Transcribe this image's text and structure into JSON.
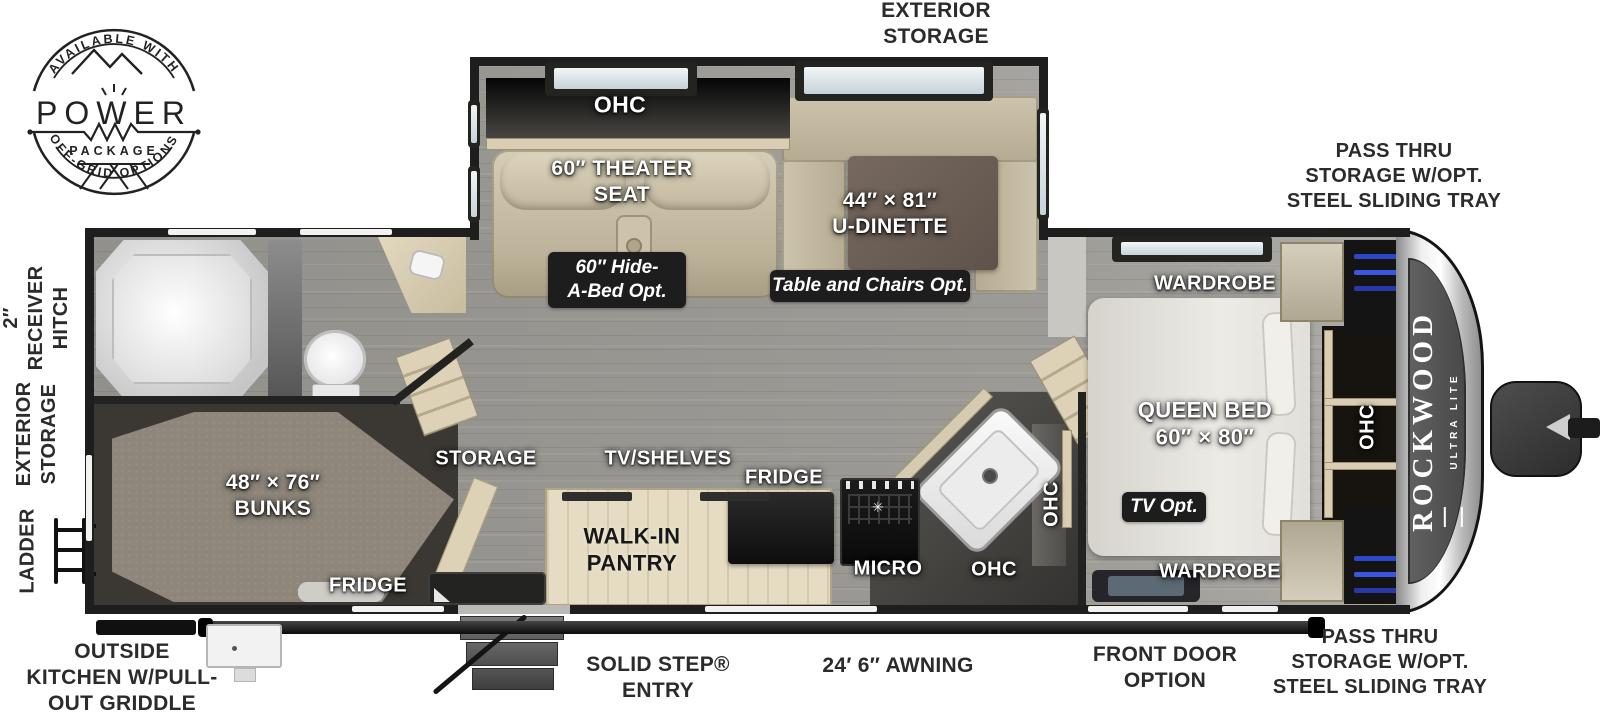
{
  "logo": {
    "arc_top": "AVAILABLE WITH",
    "word": "POWER",
    "package": "PACKAGE",
    "arc_bottom": "OFF-GRID OPTIONS"
  },
  "branding": {
    "name": "ROCKWOOD",
    "trim": "ULTRA LITE"
  },
  "exterior": {
    "top_storage": [
      "EXTERIOR",
      "STORAGE"
    ],
    "pass_thru_top": [
      "PASS THRU",
      "STORAGE W/OPT.",
      "STEEL SLIDING TRAY"
    ],
    "pass_thru_bottom": [
      "PASS THRU",
      "STORAGE W/OPT.",
      "STEEL SLIDING TRAY"
    ],
    "receiver_hitch": [
      "2″",
      "RECEIVER",
      "HITCH"
    ],
    "side_storage": [
      "EXTERIOR",
      "STORAGE"
    ],
    "ladder": "LADDER",
    "outside_kitchen": [
      "OUTSIDE",
      "KITCHEN W/PULL-",
      "OUT GRIDDLE"
    ],
    "solid_step": [
      "SOLID STEP®",
      "ENTRY"
    ],
    "awning": "24′ 6″ AWNING",
    "front_door": [
      "FRONT DOOR",
      "OPTION"
    ]
  },
  "interior": {
    "ohc_slide": "OHC",
    "theater_seat": [
      "60″ THEATER",
      "SEAT"
    ],
    "u_dinette": [
      "44″ × 81″",
      "U-DINETTE"
    ],
    "wardrobe_top": "WARDROBE",
    "wardrobe_bottom": "WARDROBE",
    "queen_bed": [
      "QUEEN BED",
      "60″ × 80″"
    ],
    "ohc_bedroom": "OHC",
    "storage": "STORAGE",
    "tv_shelves": "TV/SHELVES",
    "fridge": "FRIDGE",
    "walk_in_pantry": [
      "WALK-IN",
      "PANTRY"
    ],
    "micro": "MICRO",
    "ohc_kitchen": "OHC",
    "ohc_kitchen_wall": "OHC",
    "bunks": [
      "48″ × 76″",
      "BUNKS"
    ],
    "bunk_fridge": "FRIDGE"
  },
  "options": {
    "hide_a_bed": [
      "60″ Hide-",
      "A-Bed Opt."
    ],
    "table_chairs": "Table and Chairs Opt.",
    "tv_opt": "TV Opt."
  },
  "colors": {
    "wall": "#1e1e1e",
    "floor_gray": "#9b9994",
    "wood_tan": "#d9ceb4",
    "clothes_blue": "#2e46c8",
    "badge_bg": "#1d1d1d"
  }
}
